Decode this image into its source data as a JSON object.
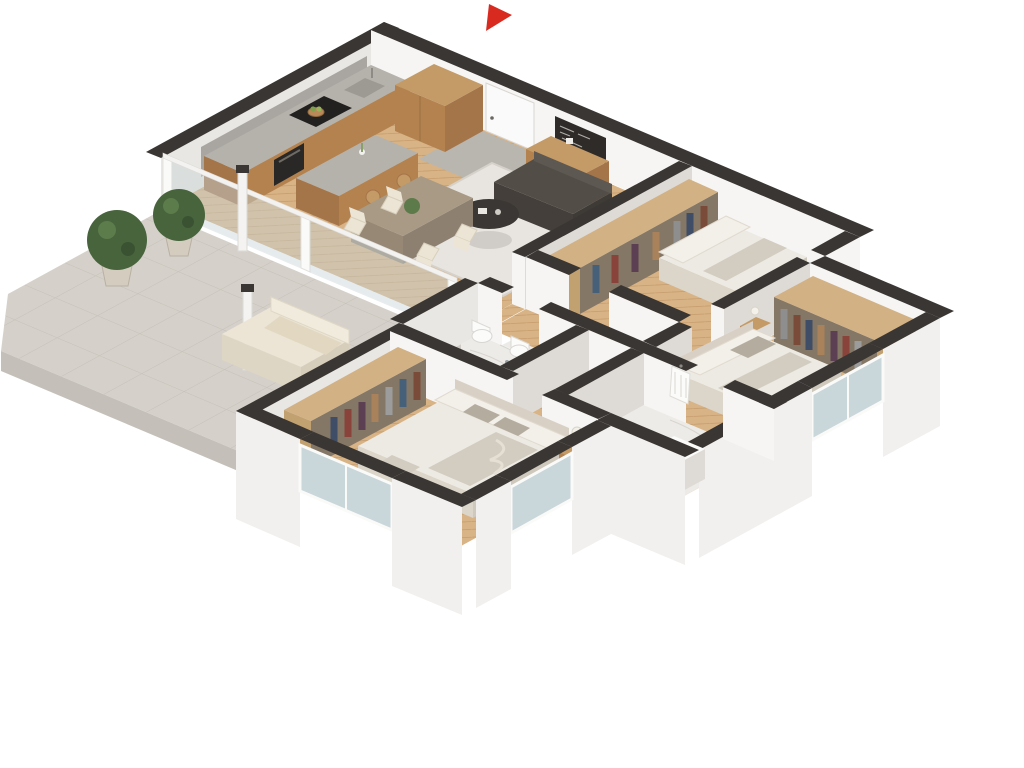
{
  "scene": {
    "title": "3D isometric apartment floor plan render",
    "view": "axonometric cutaway, white background",
    "background": "#ffffff"
  },
  "compass": {
    "name": "entrance-arrow",
    "color": "#d92a20",
    "points_to": "entrance door in top wall"
  },
  "colors": {
    "wall_top": "#3a3633",
    "face_bright": "#f6f5f3",
    "face_shaded": "#e9e7e3",
    "face_dark": "#dedbd6",
    "outer_face": "#f1f0ee",
    "backsplash": "#a9a6a1",
    "parquet": "#d8b385",
    "parquet_line": "#c79e6f",
    "marble": "#edebe7",
    "entry_tile": "#b9b6b0",
    "stone": "#d5d1ca",
    "stone_line": "#c5c1b9",
    "stone_edge": "#cfcbc4",
    "stone_edge_dark": "#c4c0b9",
    "wood_top": "#c49a66",
    "wood_front": "#b3824f",
    "wood_side": "#a5754a",
    "wood_light_top": "#d2b184",
    "wood_light_side": "#c2a171",
    "clothes_base": "#857766",
    "countertop": "#b5b2ac",
    "appliance_dark": "#22211f",
    "oven": "#2a2826",
    "sink": "#9d9a94",
    "rug": "#e8e5e0",
    "rug_edge": "#d6d2cb",
    "sofa_dark": "#524d47",
    "sofa_dark_face": "#443f3a",
    "sofa_dark_edge": "#3e3a36",
    "coffee_table": "#3a3734",
    "table_top": "#a89a85",
    "table_face": "#968875",
    "table_side": "#8d8070",
    "cream_chair": "#ece4d4",
    "linen": "#eceae3",
    "linen_shadow": "#dbd5ca",
    "linen_side": "#cfc8bc",
    "pillow": "#f3efe9",
    "pillow_accent": "#b5aca0",
    "blanket": "#d3ccc0",
    "headboard": "#d8d0c4",
    "outdoor_seat": "#ece5d6",
    "outdoor_face": "#ded6c4",
    "outdoor_side": "#d6cdbb",
    "outdoor_back": "#f1ebdd",
    "cushion": "#e2d8c2",
    "plant_green": "#47643c",
    "plant_green_light": "#5d7c4b",
    "pot": "#d3ccbf",
    "glass": "#c9d6da",
    "white_fixture": "#fbfbfa",
    "fixture_shadow": "#e8e7e4",
    "door_leaf": "#fbfafa"
  },
  "rooms": [
    {
      "id": "kitchen-living",
      "name": "open kitchen / living / dining room",
      "floor": "herringbone parquet",
      "furniture": [
        "wood kitchen counter with cooktop, sink and oven",
        "tall wood cabinet",
        "kitchen island with stools",
        "wood sideboard with chalkboard",
        "dining table with cream chairs",
        "area rug",
        "dark sofa",
        "round dark coffee table"
      ]
    },
    {
      "id": "bedroom-1",
      "name": "bedroom top-right",
      "floor": "herringbone parquet",
      "furniture": [
        "open wardrobe with clothes",
        "double bed with pillows"
      ]
    },
    {
      "id": "bedroom-2",
      "name": "bedroom right",
      "floor": "herringbone parquet",
      "furniture": [
        "large wood wardrobe with clothes",
        "double bed",
        "nightstand with lamp"
      ]
    },
    {
      "id": "master-bedroom",
      "name": "master bedroom bottom",
      "floor": "herringbone parquet",
      "furniture": [
        "long open wardrobe with clothes",
        "king bed with pillows and throw",
        "nightstand with lamp",
        "bench blanket"
      ]
    },
    {
      "id": "bathroom-1",
      "name": "bathroom center",
      "floor": "marble",
      "fixtures": [
        "wall-hung toilet",
        "bidet",
        "glass shower"
      ]
    },
    {
      "id": "bathroom-2",
      "name": "bathroom right of center",
      "floor": "marble",
      "fixtures": [
        "hanging bathrobe",
        "washbasin"
      ]
    },
    {
      "id": "corridor",
      "name": "hallway",
      "floor": "herringbone parquet",
      "furniture": []
    },
    {
      "id": "terrace",
      "name": "terrace",
      "floor": "stone tiles",
      "items": [
        "two potted boxwood topiaries",
        "outdoor loveseat with cushions",
        "glass balustrade with white posts",
        "two white columns",
        "small shrub"
      ]
    }
  ],
  "openings": {
    "entrance_door": "in top wall below red arrow",
    "windows": [
      "east wall of right bedroom",
      "east wall of master bedroom",
      "south wall of master bedroom"
    ]
  }
}
